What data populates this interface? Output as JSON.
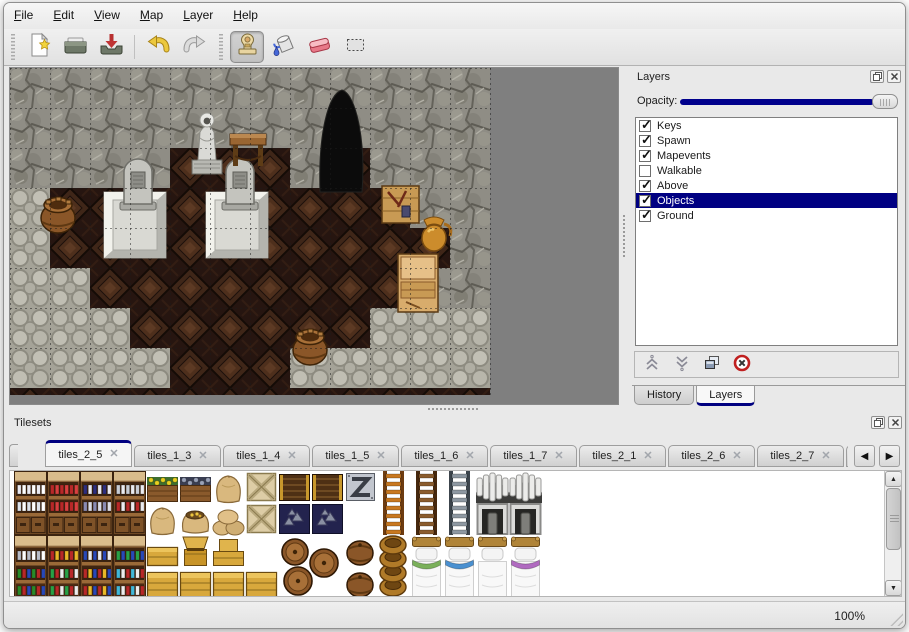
{
  "window": {
    "background": "#e9e9e9",
    "accent_navy": "#000080",
    "viewport_gray": "#7f7f7f"
  },
  "menu_bar": {
    "items": [
      {
        "label": "File"
      },
      {
        "label": "Edit"
      },
      {
        "label": "View"
      },
      {
        "label": "Map"
      },
      {
        "label": "Layer"
      },
      {
        "label": "Help"
      }
    ]
  },
  "toolbar": {
    "buttons": [
      {
        "name": "new",
        "icon": "new-file-icon",
        "group": 0
      },
      {
        "name": "open",
        "icon": "open-folder-icon",
        "group": 0
      },
      {
        "name": "save",
        "icon": "save-icon",
        "group": 0
      },
      {
        "name": "undo",
        "icon": "undo-icon",
        "group": 1
      },
      {
        "name": "redo",
        "icon": "redo-icon",
        "group": 1
      },
      {
        "name": "stamp",
        "icon": "stamp-tool-icon",
        "group": 2,
        "active": true
      },
      {
        "name": "fill",
        "icon": "fill-tool-icon",
        "group": 2
      },
      {
        "name": "eraser",
        "icon": "eraser-tool-icon",
        "group": 2
      },
      {
        "name": "select",
        "icon": "select-tool-icon",
        "group": 2
      }
    ]
  },
  "layers_panel": {
    "title": "Layers",
    "opacity_label": "Opacity:",
    "opacity_percent": 100,
    "header_icons": [
      "float-icon",
      "close-icon"
    ],
    "layers": [
      {
        "label": "Keys",
        "checked": true
      },
      {
        "label": "Spawn",
        "checked": true
      },
      {
        "label": "Mapevents",
        "checked": true
      },
      {
        "label": "Walkable",
        "checked": false
      },
      {
        "label": "Above",
        "checked": true
      },
      {
        "label": "Objects",
        "checked": true,
        "selected": true
      },
      {
        "label": "Ground",
        "checked": true
      }
    ],
    "action_icons": [
      "move-up-icon",
      "move-down-icon",
      "duplicate-layer-icon",
      "delete-layer-icon"
    ],
    "bottom_tabs": [
      {
        "label": "History"
      },
      {
        "label": "Layers",
        "active": true
      }
    ]
  },
  "tilesets_panel": {
    "title": "Tilesets",
    "header_icons": [
      "float-icon",
      "close-icon"
    ],
    "tabs": [
      {
        "label": "tiles_2_5",
        "active": true
      },
      {
        "label": "tiles_1_3"
      },
      {
        "label": "tiles_1_4"
      },
      {
        "label": "tiles_1_5"
      },
      {
        "label": "tiles_1_6"
      },
      {
        "label": "tiles_1_7"
      },
      {
        "label": "tiles_2_1"
      },
      {
        "label": "tiles_2_6"
      },
      {
        "label": "tiles_2_7"
      },
      {
        "label": "tiles_2",
        "clipped": true
      }
    ],
    "scroll_arrows": [
      "tab-scroll-left-icon",
      "tab-scroll-right-icon"
    ]
  },
  "status_bar": {
    "zoom": "100%"
  },
  "map": {
    "tile_size": 40,
    "legend": {
      "W": "rock-wall",
      "C": "cobblestone",
      "F": "dark-wood-floor"
    },
    "terrain_rows": [
      "WWWWWWWWWWWW",
      "WWWWWWWWDWWW",
      "WWWWFFFWFWWW",
      "CFFFFFFFFFWW",
      "CFFFFFFFFFFW",
      "CCFFFFFFFFWW",
      "CCCFFFFFFCCC",
      "CCCCFFFCCCCC"
    ],
    "cave_entrance": {
      "x": 332,
      "y": 24
    },
    "objects": [
      {
        "type": "platform",
        "x": 94,
        "y": 124
      },
      {
        "type": "platform",
        "x": 196,
        "y": 124
      },
      {
        "type": "gravestone",
        "x": 112,
        "y": 88
      },
      {
        "type": "gravestone",
        "x": 214,
        "y": 88
      },
      {
        "type": "statue",
        "x": 178,
        "y": 40
      },
      {
        "type": "table",
        "x": 220,
        "y": 62
      },
      {
        "type": "barrel",
        "x": 30,
        "y": 124
      },
      {
        "type": "crate",
        "x": 372,
        "y": 116
      },
      {
        "type": "pot",
        "x": 406,
        "y": 146
      },
      {
        "type": "cabinet",
        "x": 388,
        "y": 186
      },
      {
        "type": "barrel",
        "x": 282,
        "y": 256
      }
    ]
  },
  "tileset_tiles": [
    {
      "kind": "bookcase",
      "x": 0,
      "y": 0,
      "colors": [
        [
          "#e8e8f0",
          "#ffffff"
        ],
        [
          "#dde2ea",
          "#ffffff"
        ]
      ]
    },
    {
      "kind": "bookcase",
      "x": 33,
      "y": 0,
      "colors": [
        [
          "#b82828",
          "#d84040"
        ],
        [
          "#b82828",
          "#d84040"
        ]
      ]
    },
    {
      "kind": "bookcase",
      "x": 66,
      "y": 0,
      "colors": [
        [
          "#2e2e7e",
          "#eaeaf2"
        ],
        [
          "#8a8ab2",
          "#dcdce6"
        ]
      ]
    },
    {
      "kind": "bookcase",
      "x": 99,
      "y": 0,
      "colors": [
        [
          "#c8ccd4",
          "#ebebef"
        ],
        [
          "#b82828",
          "#ebebef"
        ]
      ]
    },
    {
      "kind": "planter",
      "x": 132,
      "y": 0,
      "bloom": "#e8d020",
      "leaf": "#3e6e2e"
    },
    {
      "kind": "planter",
      "x": 165,
      "y": 0,
      "bloom": "#9aa2b8",
      "leaf": "#3a3e52"
    },
    {
      "kind": "sack",
      "x": 198,
      "y": 0
    },
    {
      "kind": "xcrate",
      "x": 231,
      "y": 0
    },
    {
      "kind": "slatcrate",
      "x": 264,
      "y": 0
    },
    {
      "kind": "slatcrate",
      "x": 297,
      "y": 0
    },
    {
      "kind": "sign",
      "x": 330,
      "y": 0
    },
    {
      "kind": "ladder",
      "x": 363,
      "y": 0,
      "c": "#c87820",
      "rail": "#6e3c10"
    },
    {
      "kind": "ladder",
      "x": 396,
      "y": 0,
      "c": "#8a5c2e",
      "rail": "#46280e"
    },
    {
      "kind": "ladder",
      "x": 429,
      "y": 0,
      "c": "#8e98a2",
      "rail": "#3c444c"
    },
    {
      "kind": "arch",
      "x": 462,
      "y": 0
    },
    {
      "kind": "arch",
      "x": 495,
      "y": 0
    },
    {
      "kind": "sack",
      "x": 132,
      "y": 32
    },
    {
      "kind": "sackopen",
      "x": 165,
      "y": 32
    },
    {
      "kind": "sackpile",
      "x": 198,
      "y": 32
    },
    {
      "kind": "xcrate",
      "x": 231,
      "y": 32
    },
    {
      "kind": "orepile",
      "x": 264,
      "y": 32
    },
    {
      "kind": "orepile",
      "x": 297,
      "y": 32
    },
    {
      "kind": "doorway",
      "x": 462,
      "y": 32
    },
    {
      "kind": "doorway",
      "x": 495,
      "y": 32
    },
    {
      "kind": "shelfunit",
      "x": 0,
      "y": 64,
      "colors": [
        [
          "#b8bcc8",
          "#ffffff"
        ],
        [
          "#288a28",
          "#b82828",
          "#2848b8"
        ]
      ]
    },
    {
      "kind": "shelfunit",
      "x": 33,
      "y": 64,
      "colors": [
        [
          "#b82828",
          "#e8b828"
        ],
        [
          "#28a046",
          "#b82828",
          "#ececec"
        ]
      ]
    },
    {
      "kind": "shelfunit",
      "x": 66,
      "y": 64,
      "colors": [
        [
          "#2848b8",
          "#ececec"
        ],
        [
          "#b82828",
          "#e8b828",
          "#2848b8"
        ]
      ]
    },
    {
      "kind": "shelfunit",
      "x": 99,
      "y": 64,
      "colors": [
        [
          "#28a046",
          "#2848b8"
        ],
        [
          "#40b8d8",
          "#ececec",
          "#b82828"
        ]
      ]
    },
    {
      "kind": "goldlow",
      "x": 132,
      "y": 64
    },
    {
      "kind": "goldchest",
      "x": 165,
      "y": 64
    },
    {
      "kind": "goldbox",
      "x": 198,
      "y": 64
    },
    {
      "kind": "goldcrate",
      "x": 132,
      "y": 96
    },
    {
      "kind": "goldcrate",
      "x": 165,
      "y": 96
    },
    {
      "kind": "goldcrate",
      "x": 198,
      "y": 96
    },
    {
      "kind": "goldcrate",
      "x": 231,
      "y": 96
    },
    {
      "kind": "barrelcluster",
      "x": 264,
      "y": 64
    },
    {
      "kind": "barrel",
      "x": 330,
      "y": 64
    },
    {
      "kind": "barrel",
      "x": 330,
      "y": 96
    },
    {
      "kind": "potstack",
      "x": 363,
      "y": 64
    },
    {
      "kind": "bed",
      "x": 396,
      "y": 64,
      "trim": "#7ab05a"
    },
    {
      "kind": "bed",
      "x": 429,
      "y": 64,
      "trim": "#4a90d0"
    },
    {
      "kind": "bed",
      "x": 462,
      "y": 64,
      "trim": null
    },
    {
      "kind": "bed",
      "x": 495,
      "y": 64,
      "trim": "#b06ac0"
    }
  ]
}
